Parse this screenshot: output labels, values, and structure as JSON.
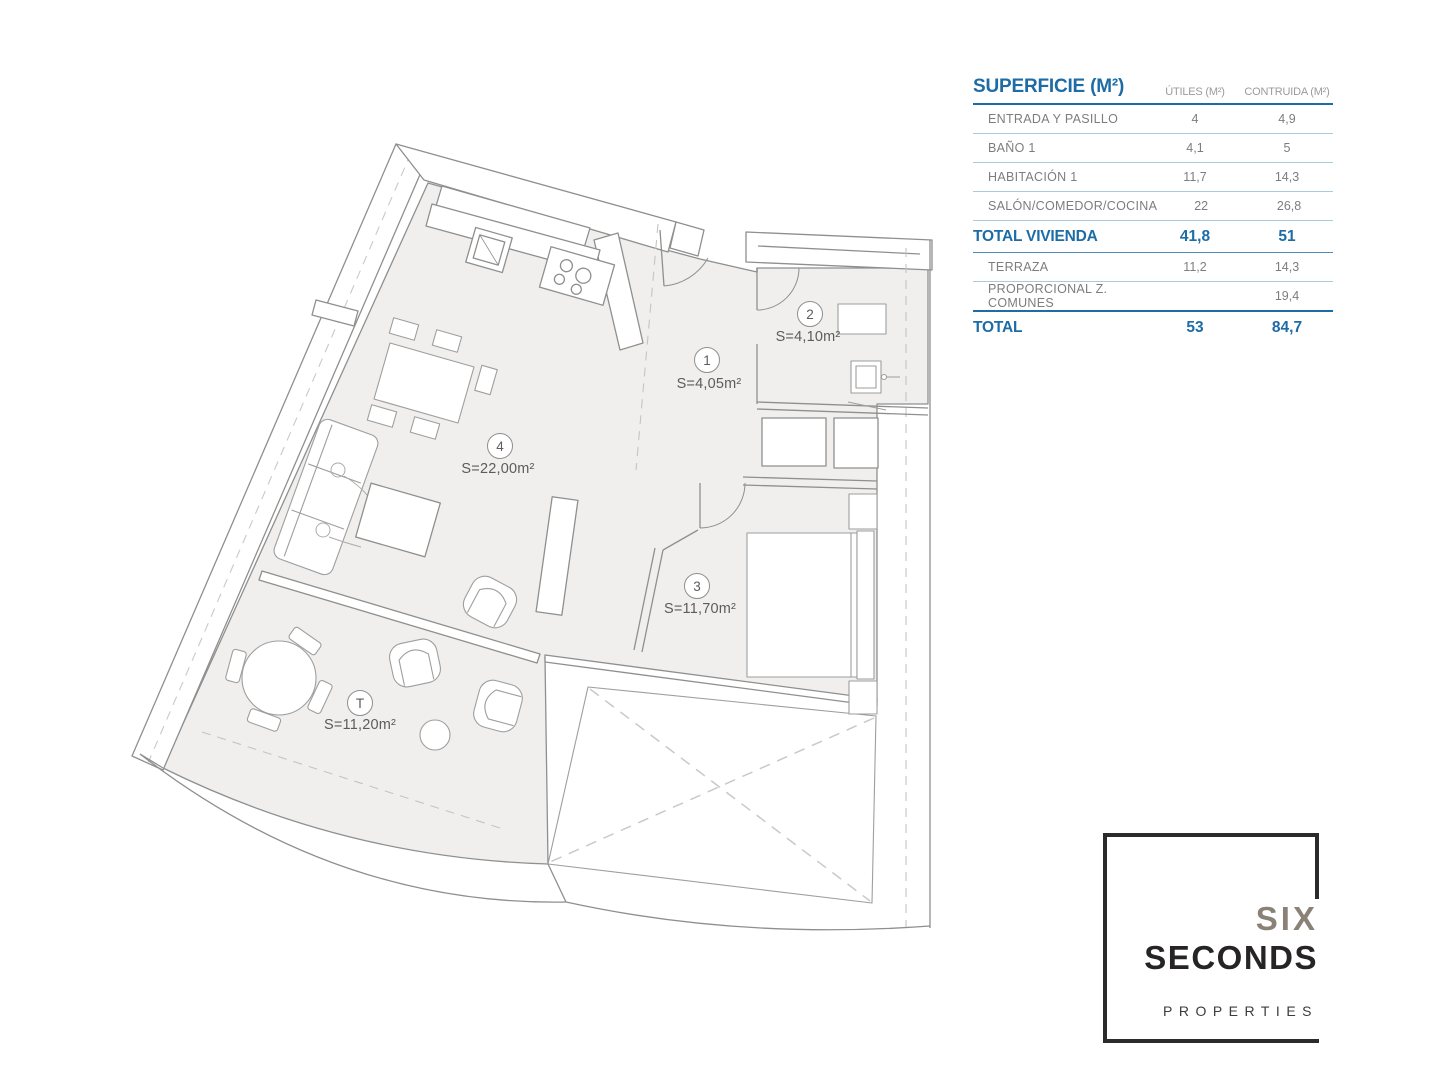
{
  "plan": {
    "rooms": [
      {
        "id": "1",
        "area_label": "S=4,05m²"
      },
      {
        "id": "2",
        "area_label": "S=4,10m²"
      },
      {
        "id": "3",
        "area_label": "S=11,70m²"
      },
      {
        "id": "4",
        "area_label": "S=22,00m²"
      },
      {
        "id": "T",
        "area_label": "S=11,20m²"
      }
    ]
  },
  "table": {
    "title": "SUPERFICIE (M²)",
    "columns": [
      "ÚTILES (M²)",
      "CONTRUIDA (M²)"
    ],
    "rows": [
      {
        "label": "ENTRADA Y PASILLO",
        "utiles": "4",
        "contruida": "4,9"
      },
      {
        "label": "BAÑO 1",
        "utiles": "4,1",
        "contruida": "5"
      },
      {
        "label": "HABITACIÓN 1",
        "utiles": "11,7",
        "contruida": "14,3"
      },
      {
        "label": "SALÓN/COMEDOR/COCINA",
        "utiles": "22",
        "contruida": "26,8"
      },
      {
        "label": "TOTAL VIVIENDA",
        "utiles": "41,8",
        "contruida": "51"
      },
      {
        "label": "TERRAZA",
        "utiles": "11,2",
        "contruida": "14,3"
      },
      {
        "label": "PROPORCIONAL Z. COMUNES",
        "utiles": "",
        "contruida": "19,4"
      },
      {
        "label": "TOTAL",
        "utiles": "53",
        "contruida": "84,7"
      }
    ],
    "accent_color": "#1d6ca6"
  },
  "logo": {
    "line1": "SIX",
    "line2": "SECONDS",
    "line3": "PROPERTIES"
  }
}
